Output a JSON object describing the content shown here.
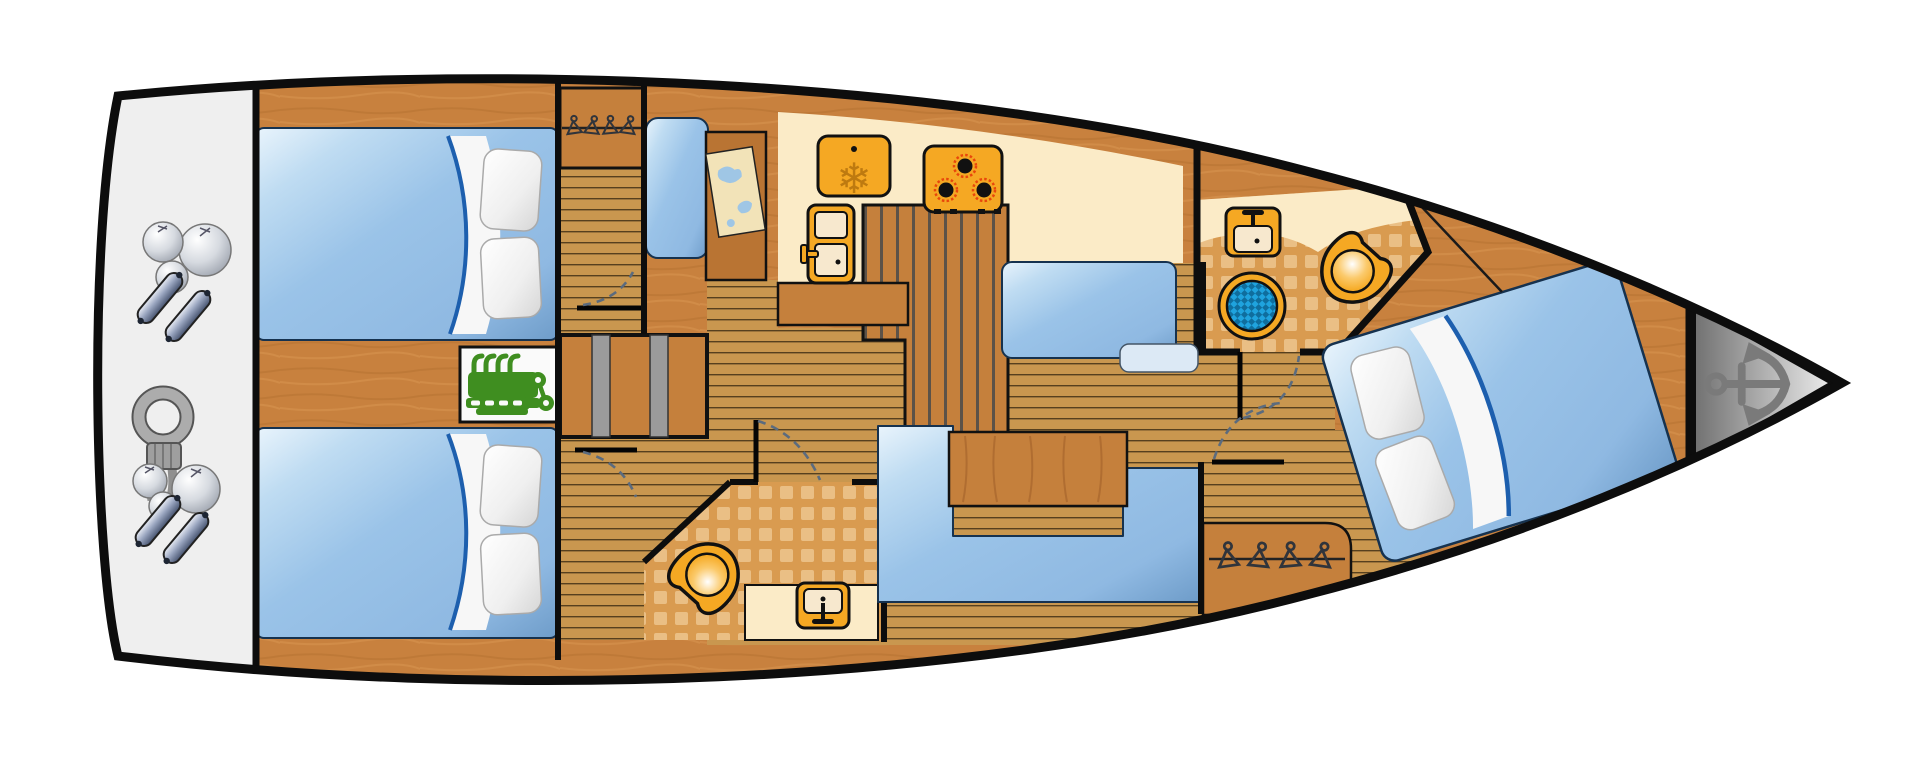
{
  "diagram": {
    "type": "sailboat-interior-floor-plan",
    "orientation": "bow-right-stern-left",
    "regions": [
      "swim-platform",
      "aft-cabin-starboard",
      "aft-cabin-port",
      "engine-compartment",
      "companionway-steps",
      "wardrobe-aft",
      "wardrobe-forward",
      "navigation-station",
      "galley",
      "salon",
      "aft-head",
      "forward-head",
      "corridor",
      "forward-cabin",
      "anchor-locker"
    ],
    "furniture": {
      "double-beds": 3,
      "settees": 2,
      "salon-table": 1,
      "nav-desk-with-chart": 1,
      "galley-counter": 1
    },
    "icons": [
      "engine-icon",
      "anchor-icon",
      "fridge-freezer-icon",
      "stove-burners-icon",
      "refrigerator-door-icon",
      "sink-icon",
      "toilet-icon",
      "shower-drain-icon",
      "clothes-hanger-icon",
      "fender-ball-icon",
      "fender-cylinder-icon",
      "rope-coil-icon",
      "door-swing-arc",
      "chart-map-icon",
      "snowflake-icon",
      "pillow-icon"
    ]
  },
  "colors": {
    "hull-outline": "#0D0D0D",
    "base-wood": "#C8813E",
    "base-wood-streak": "#B26E2F",
    "furniture-wood": "#C5803C",
    "floor-tan": "#C9974F",
    "floor-line": "#3A2B12",
    "counter-stripe": "#4A4A4A",
    "cream": "#FBEBC7",
    "basin-cream": "#F7E8CE",
    "tile-base": "#D99B50",
    "tile-square": "#EABF85",
    "bed-blue": "#9AC3E8",
    "bed-blue-dark": "#6E9CC9",
    "bed-outline": "#16324F",
    "pillow-white": "#F5F5F5",
    "sheet-blue-edge": "#1D5FAE",
    "appliance-orange": "#F5A823",
    "snowflake-orange": "#BE7A10",
    "burner-red": "#E8470B",
    "engine-green": "#3F8E20",
    "drain-blue": "#1FA3DE",
    "drain-blue-dark": "#0F6E9E",
    "platform-gray": "#EFEFEF",
    "anchor-gray": "#7A7A7A",
    "fender-steel": "#9AA6C0",
    "rope-gray": "#ACACAC",
    "door-arc": "#5B6B7E"
  }
}
